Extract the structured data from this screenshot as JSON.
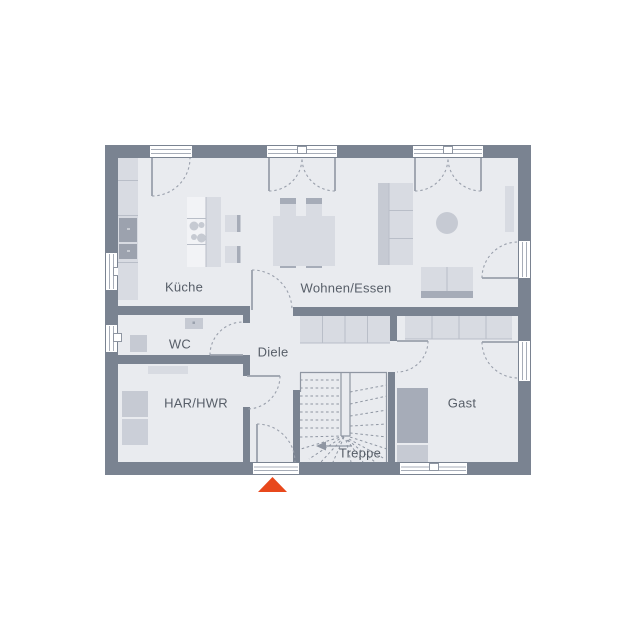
{
  "plan": {
    "title": "floor-plan-ground-floor",
    "rooms": [
      {
        "id": "kueche",
        "label": "Küche"
      },
      {
        "id": "wohnen_essen",
        "label": "Wohnen/Essen"
      },
      {
        "id": "wc",
        "label": "WC"
      },
      {
        "id": "diele",
        "label": "Diele"
      },
      {
        "id": "har_hwr",
        "label": "HAR/HWR"
      },
      {
        "id": "treppe",
        "label": "Treppe"
      },
      {
        "id": "gast",
        "label": "Gast"
      }
    ],
    "markers": [
      {
        "id": "entrance-marker",
        "shape": "triangle-up",
        "color": "#E8481C"
      },
      {
        "id": "stair-direction-arrow",
        "shape": "arrow-left",
        "color": "#8F96A2"
      }
    ],
    "colors": {
      "wall": "#7A8391",
      "floor": "#E9EBEF",
      "furniture_light": "#D8DBE2",
      "furniture_mid": "#C6CAD3",
      "furniture_dark": "#A6ACB8",
      "appliance": "#9CA2AE",
      "line": "#9AA0AC",
      "label_text": "#575E68",
      "accent": "#E8481C"
    }
  }
}
